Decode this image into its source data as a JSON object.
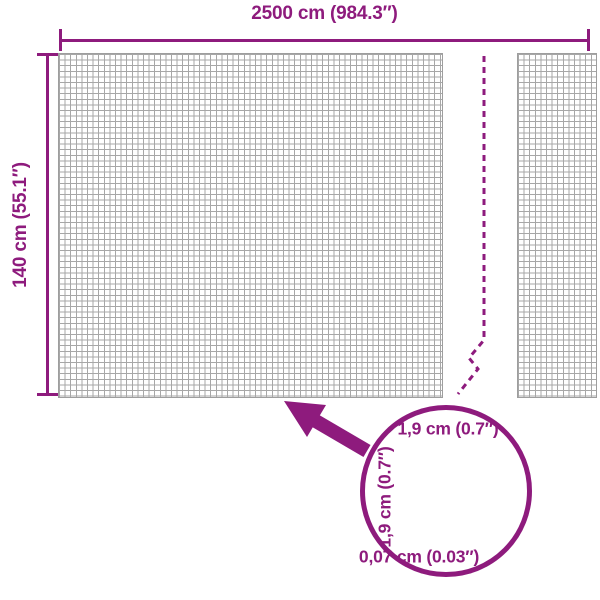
{
  "colors": {
    "accent": "#8e1b7d",
    "mesh_line": "#a7a7a7",
    "detail_grid": "#a3a8a8",
    "background": "#ffffff"
  },
  "overall_dimensions": {
    "width_label": "2500 cm (984.3″)",
    "height_label": "140 cm (55.1″)"
  },
  "detail_view": {
    "mesh_opening_width_label": "1,9 cm (0.7″)",
    "mesh_opening_height_label": "1,9 cm (0.7″)",
    "wire_thickness_label": "0,07 cm (0.03″)"
  },
  "icons": {
    "zoom_arrow": "arrow-pointing-from-detail-circle-to-mesh",
    "break_line": "dashed-break-continuation-line",
    "detail_circle": "magnifier-detail-circle"
  }
}
